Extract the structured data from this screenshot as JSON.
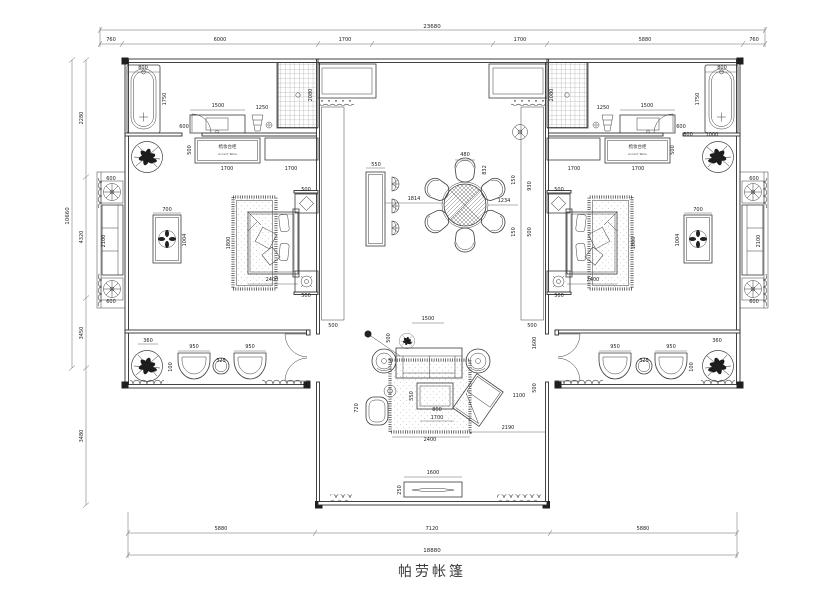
{
  "title": {
    "text": "帕劳帐篷"
  },
  "colors": {
    "background": "#ffffff",
    "line": "#3b3b3b",
    "dim_text": "#1c1c1c"
  },
  "labels": {
    "accent_cn": "梳妆台柜",
    "accent_en": "Accent Table"
  },
  "dimensions": {
    "top_overall": "23680",
    "bottom_overall": "18880",
    "left_overall": "10660",
    "top_segments": [
      "760",
      "6000",
      "1700",
      "1700",
      "5880",
      "760"
    ],
    "bottom_segments": [
      "5880",
      "7120",
      "5880"
    ],
    "left_segments": [
      "2280",
      "4320",
      "3450",
      "3480"
    ]
  },
  "annotations": [
    {
      "x": 111,
      "y": 41,
      "t": "760"
    },
    {
      "x": 220,
      "y": 41,
      "t": "6000"
    },
    {
      "x": 345,
      "y": 41,
      "t": "1700"
    },
    {
      "x": 520,
      "y": 41,
      "t": "1700"
    },
    {
      "x": 645,
      "y": 41,
      "t": "5880"
    },
    {
      "x": 754,
      "y": 41,
      "t": "760"
    },
    {
      "x": 221,
      "y": 530,
      "t": "5880"
    },
    {
      "x": 432,
      "y": 530,
      "t": "7120"
    },
    {
      "x": 643,
      "y": 530,
      "t": "5880"
    },
    {
      "x": 83,
      "y": 118,
      "t": "2280",
      "r": 1
    },
    {
      "x": 83,
      "y": 237,
      "t": "4320",
      "r": 1
    },
    {
      "x": 83,
      "y": 333,
      "t": "3450",
      "r": 1
    },
    {
      "x": 83,
      "y": 436,
      "t": "3480",
      "r": 1
    },
    {
      "x": 143,
      "y": 69,
      "t": "800"
    },
    {
      "x": 166,
      "y": 99,
      "t": "1750",
      "r": 1
    },
    {
      "x": 218,
      "y": 107,
      "t": "1500"
    },
    {
      "x": 184,
      "y": 128,
      "t": "600"
    },
    {
      "x": 262,
      "y": 109,
      "t": "1250"
    },
    {
      "x": 312,
      "y": 95,
      "t": "2080",
      "r": 1
    },
    {
      "x": 191,
      "y": 150,
      "t": "500",
      "r": 1
    },
    {
      "x": 227,
      "y": 170,
      "t": "1700"
    },
    {
      "x": 291,
      "y": 170,
      "t": "1700"
    },
    {
      "x": 272,
      "y": 281,
      "t": "2400"
    },
    {
      "x": 230,
      "y": 243,
      "t": "1800",
      "r": 1
    },
    {
      "x": 306,
      "y": 191,
      "t": "500"
    },
    {
      "x": 306,
      "y": 297,
      "t": "500"
    },
    {
      "x": 333,
      "y": 327,
      "t": "500"
    },
    {
      "x": 148,
      "y": 342,
      "t": "360"
    },
    {
      "x": 194,
      "y": 348,
      "t": "950"
    },
    {
      "x": 250,
      "y": 348,
      "t": "950"
    },
    {
      "x": 221,
      "y": 362,
      "t": "325"
    },
    {
      "x": 172,
      "y": 367,
      "t": "100",
      "r": 1
    },
    {
      "x": 105,
      "y": 241,
      "t": "2100",
      "r": 1
    },
    {
      "x": 111,
      "y": 180,
      "t": "600"
    },
    {
      "x": 111,
      "y": 303,
      "t": "600"
    },
    {
      "x": 167,
      "y": 211,
      "t": "700"
    },
    {
      "x": 186,
      "y": 240,
      "t": "1004",
      "r": 1
    },
    {
      "x": 722,
      "y": 69,
      "t": "800"
    },
    {
      "x": 699,
      "y": 99,
      "t": "1750",
      "r": 1
    },
    {
      "x": 647,
      "y": 107,
      "t": "1500"
    },
    {
      "x": 681,
      "y": 128,
      "t": "600"
    },
    {
      "x": 603,
      "y": 109,
      "t": "1250"
    },
    {
      "x": 553,
      "y": 95,
      "t": "2080",
      "r": 1
    },
    {
      "x": 674,
      "y": 150,
      "t": "500",
      "r": 1
    },
    {
      "x": 638,
      "y": 170,
      "t": "1700"
    },
    {
      "x": 574,
      "y": 170,
      "t": "1700"
    },
    {
      "x": 593,
      "y": 281,
      "t": "2400"
    },
    {
      "x": 635,
      "y": 243,
      "t": "1800",
      "r": 1
    },
    {
      "x": 559,
      "y": 191,
      "t": "500"
    },
    {
      "x": 559,
      "y": 297,
      "t": "500"
    },
    {
      "x": 532,
      "y": 327,
      "t": "500"
    },
    {
      "x": 717,
      "y": 342,
      "t": "360"
    },
    {
      "x": 671,
      "y": 348,
      "t": "950"
    },
    {
      "x": 615,
      "y": 348,
      "t": "950"
    },
    {
      "x": 644,
      "y": 362,
      "t": "325"
    },
    {
      "x": 693,
      "y": 367,
      "t": "100",
      "r": 1
    },
    {
      "x": 760,
      "y": 241,
      "t": "2100",
      "r": 1
    },
    {
      "x": 754,
      "y": 180,
      "t": "600"
    },
    {
      "x": 754,
      "y": 303,
      "t": "600"
    },
    {
      "x": 698,
      "y": 211,
      "t": "700"
    },
    {
      "x": 679,
      "y": 240,
      "t": "1004",
      "r": 1
    },
    {
      "x": 688,
      "y": 136,
      "t": "800"
    },
    {
      "x": 712,
      "y": 136,
      "t": "1000"
    },
    {
      "x": 376,
      "y": 166,
      "t": "550"
    },
    {
      "x": 414,
      "y": 200,
      "t": "1814"
    },
    {
      "x": 465,
      "y": 156,
      "t": "480"
    },
    {
      "x": 486,
      "y": 170,
      "t": "832",
      "r": 1
    },
    {
      "x": 504,
      "y": 202,
      "t": "1234"
    },
    {
      "x": 515,
      "y": 180,
      "t": "150",
      "r": 1
    },
    {
      "x": 515,
      "y": 232,
      "t": "150",
      "r": 1
    },
    {
      "x": 531,
      "y": 186,
      "t": "930",
      "r": 1
    },
    {
      "x": 531,
      "y": 232,
      "t": "500",
      "r": 1
    },
    {
      "x": 428,
      "y": 320,
      "t": "1500"
    },
    {
      "x": 390,
      "y": 338,
      "t": "500",
      "r": 1
    },
    {
      "x": 536,
      "y": 343,
      "t": "1600",
      "r": 1
    },
    {
      "x": 536,
      "y": 388,
      "t": "500",
      "r": 1
    },
    {
      "x": 430,
      "y": 441,
      "t": "2400"
    },
    {
      "x": 437,
      "y": 419,
      "t": "1700"
    },
    {
      "x": 508,
      "y": 429,
      "t": "2190"
    },
    {
      "x": 519,
      "y": 397,
      "t": "1100"
    },
    {
      "x": 358,
      "y": 408,
      "t": "720",
      "r": 1
    },
    {
      "x": 437,
      "y": 411,
      "t": "800"
    },
    {
      "x": 413,
      "y": 396,
      "t": "550",
      "r": 1
    },
    {
      "x": 433,
      "y": 474,
      "t": "1600"
    },
    {
      "x": 401,
      "y": 490,
      "t": "250",
      "r": 1
    }
  ]
}
